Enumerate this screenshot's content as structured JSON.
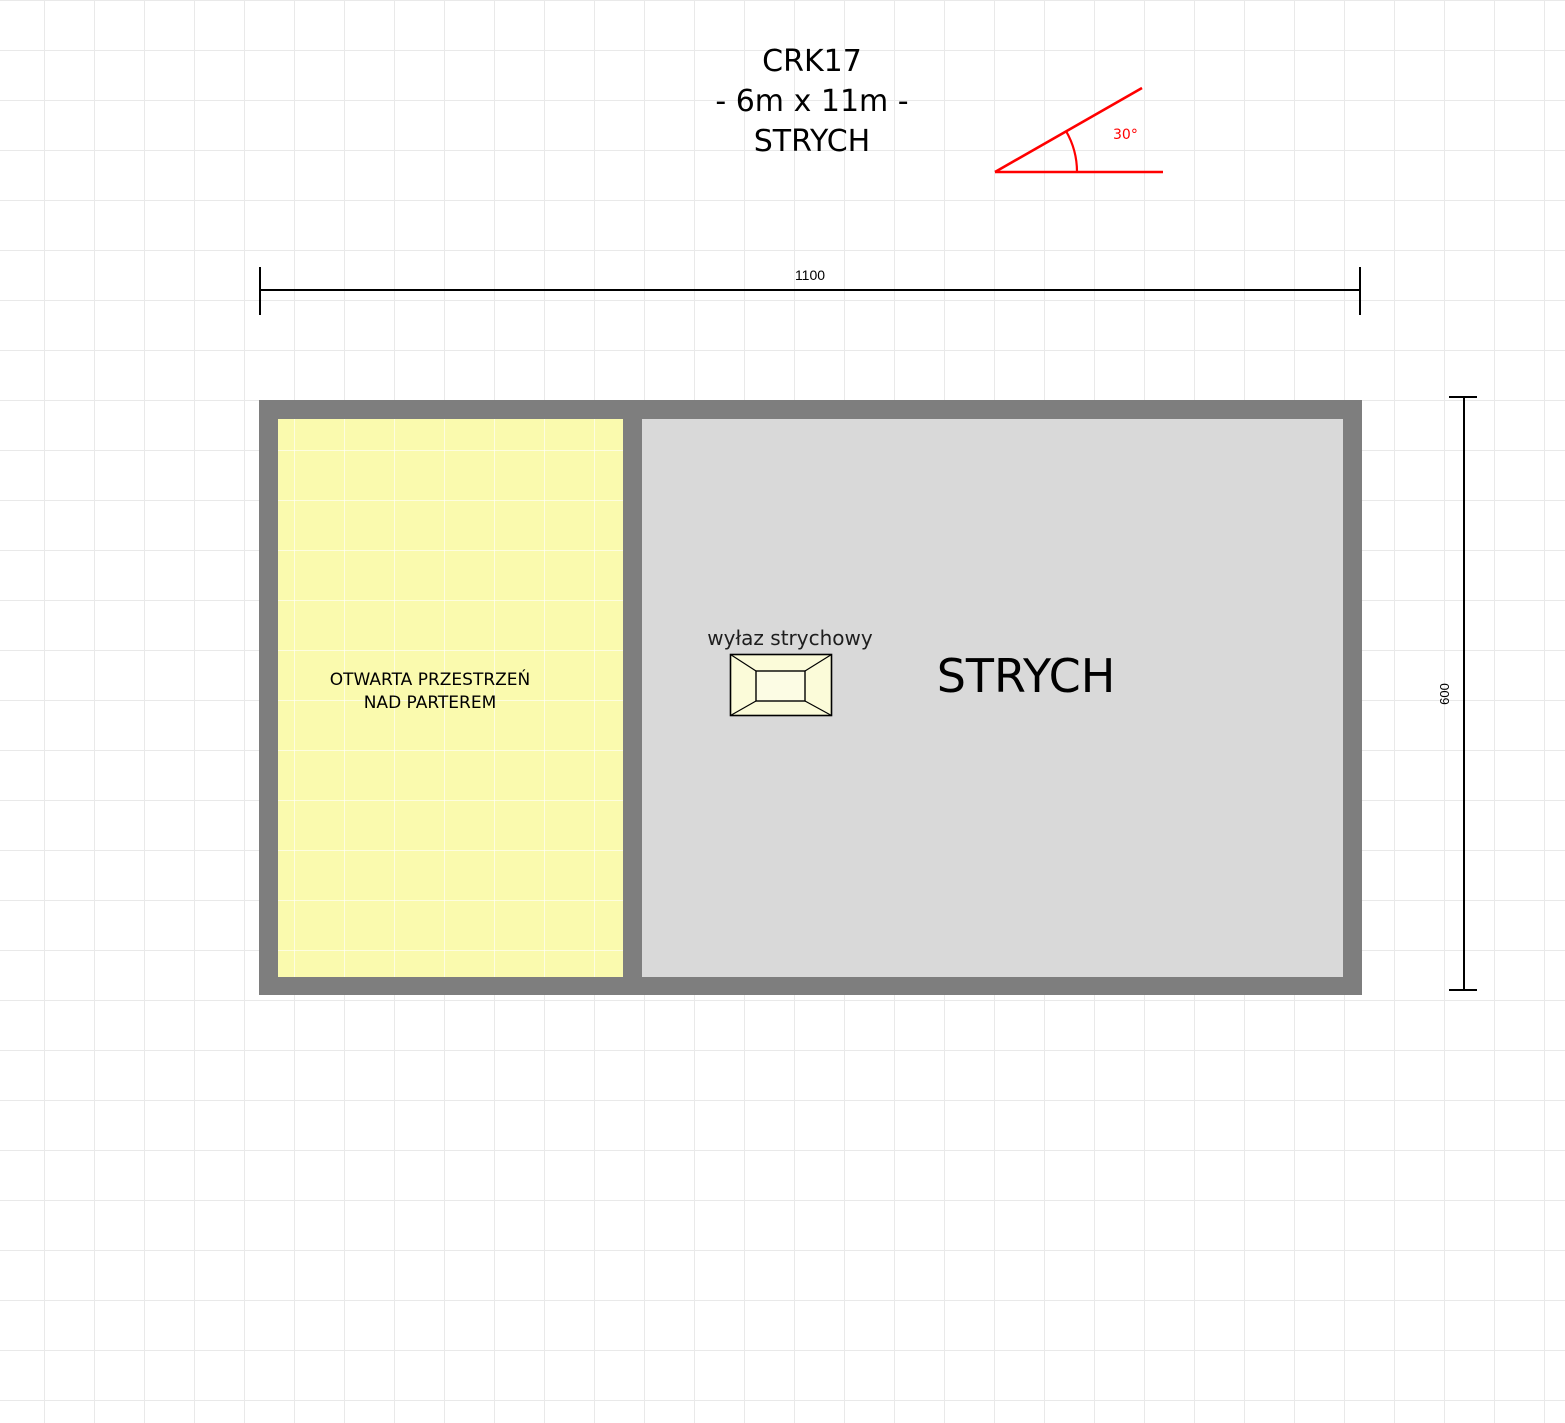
{
  "title": {
    "line1": "CRK17",
    "line2": "- 6m x 11m -",
    "line3": "STRYCH"
  },
  "angle_marker": {
    "label": "30°",
    "color": "#ff0000"
  },
  "dimensions": {
    "horizontal_width": "1100",
    "vertical_height": "600"
  },
  "plan": {
    "wall_color": "#7e7e7e",
    "rooms": [
      {
        "id": "open-space",
        "label_line1": "OTWARTA PRZESTRZEŃ",
        "label_line2": "NAD PARTEREM",
        "fill": "#fafaae"
      },
      {
        "id": "attic",
        "label": "STRYCH",
        "fill": "#d9d9d9"
      }
    ],
    "hatch": {
      "label": "wyłaz strychowy",
      "fill": "#fbfbd9"
    }
  },
  "colors": {
    "background": "#ffffff",
    "grid_line": "#e9e9e9",
    "dimension_line": "#000000",
    "accent_red": "#ff0000",
    "text": "#000000"
  }
}
